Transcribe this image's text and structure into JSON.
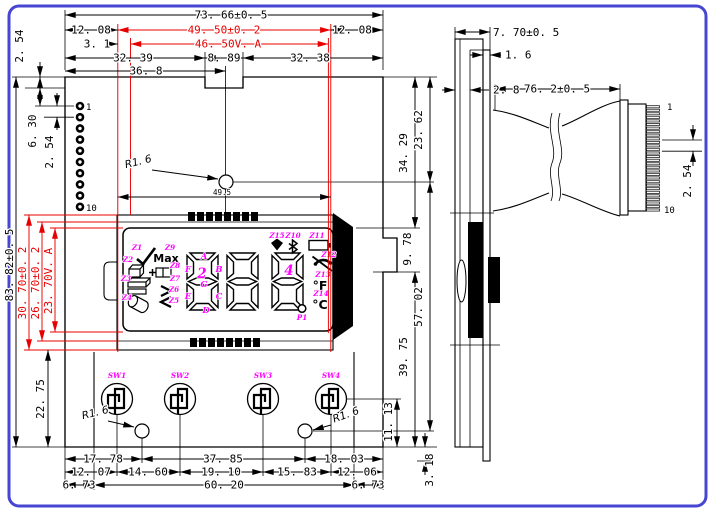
{
  "front": {
    "dims": {
      "overall_w": "73. 66±0. 5",
      "edge_l": "12. 08",
      "edge_r": "12. 08",
      "lcd_w": "49. 50±0. 2",
      "va_off": "3. 1",
      "va_w": "46. 50V. A",
      "notch_l": "32. 39",
      "notch_w": "8. 89",
      "notch_r": "32. 38",
      "hole_x": "36. 8",
      "notch_d": "2. 54",
      "overall_h": "83. 82±0. 5",
      "lcd_h": "30. 70±0. 2",
      "lcd_h2": "26. 70±0. 2",
      "va_h": "23. 70V. A",
      "pin_first_y": "6. 30",
      "pin_pitch": "2. 54",
      "bottom_h": "22. 75",
      "glass_ref": "49.5",
      "disp_top": "34. 29",
      "hole_top": "23. 62",
      "disp_h": "9. 78",
      "hole_span": "57. 02",
      "lower_h": "39. 75",
      "sw_h": "11. 13",
      "tail": "3. 18",
      "r_top": "R1. 6",
      "r_bl": "R1. 6",
      "r_br": "R1. 6",
      "row1": [
        "17. 78",
        "37. 85",
        "18. 03"
      ],
      "row2": [
        "12. 07",
        "14. 60",
        "19. 10",
        "15. 83",
        "12. 06"
      ],
      "row3": [
        "6. 73",
        "60. 20",
        "6. 73"
      ]
    },
    "pin_first": "1",
    "pin_last": "10",
    "switches": [
      "SW1",
      "SW2",
      "SW3",
      "SW4"
    ],
    "lcd": {
      "z1": "Z1",
      "z2": "Z2",
      "z3": "Z3",
      "z4": "Z4",
      "z5": "Z5",
      "z6": "Z6",
      "z7": "Z7",
      "z8": "Z8",
      "z9": "Z9",
      "z10": "Z10",
      "z11": "Z11",
      "z12": "Z12",
      "z13": "Z13",
      "z14": "Z14",
      "z15": "Z15",
      "max": "Max",
      "digit1": "2",
      "digit3": "4",
      "point": "P1",
      "seg_a": "A",
      "seg_b": "B",
      "seg_c": "C",
      "seg_d": "D",
      "seg_e": "E",
      "seg_f": "F",
      "seg_g": "G",
      "fahrenheit": "°F",
      "celsius": "°C"
    }
  },
  "side": {
    "dims": {
      "thickness": "7. 70±0. 5",
      "pcb_t": "1. 6",
      "lip": "2. 8",
      "cable_l": "76. 2±0. 5",
      "pitch": "2. 54"
    },
    "pin_first": "1",
    "pin_last": "10"
  },
  "colors": {
    "dim_red": "#e80000",
    "label_magenta": "#ff00ff",
    "border_blue": "#4646d2"
  }
}
